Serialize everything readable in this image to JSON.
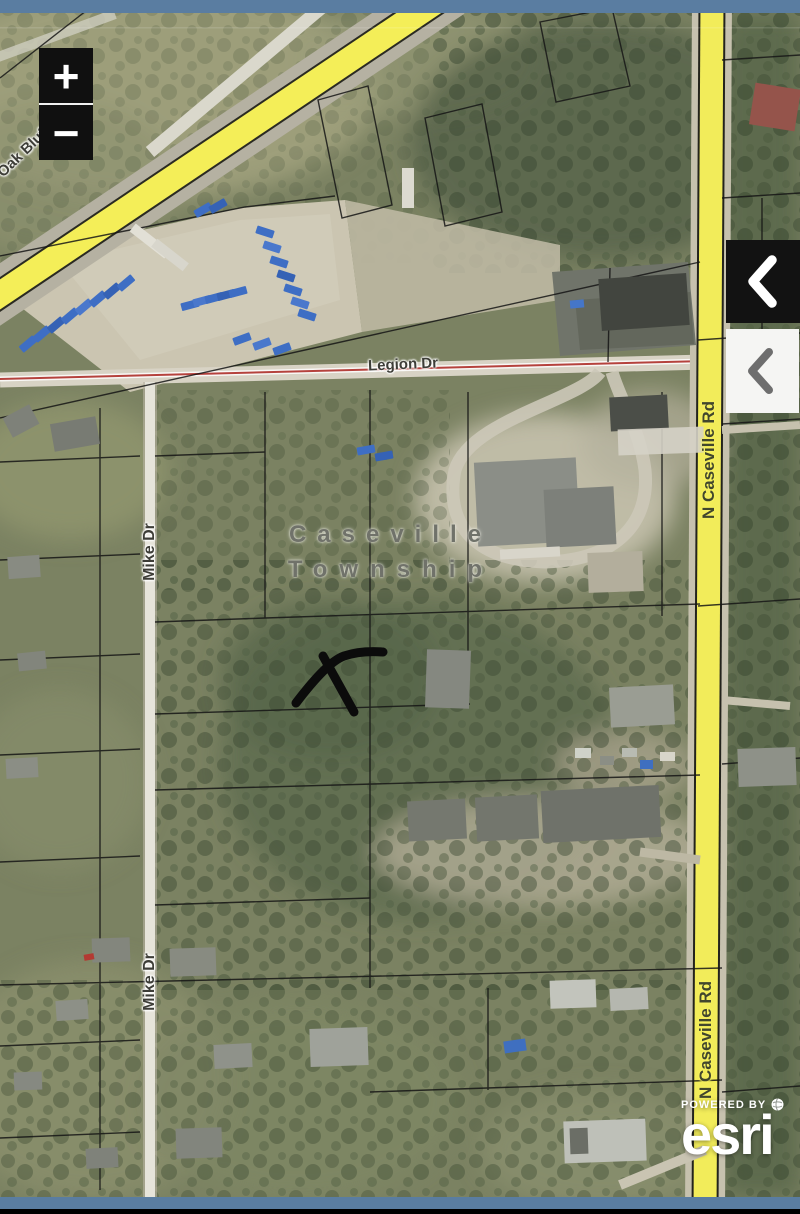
{
  "chrome": {
    "top_bar_color": "#5a7da1",
    "bottom_bar_color": "#5a7da1",
    "bottom_strip_color": "#000000"
  },
  "map": {
    "place_label": {
      "line1": "Caseville",
      "line2": "Township"
    },
    "road_labels": {
      "oak_bluff": "Oak Bluff Rd",
      "legion": "Legion Dr",
      "mike": "Mike Dr",
      "n_caseville": "N Caseville Rd"
    },
    "annotation": {
      "type": "freehand-x-mark",
      "color": "#0b0b0b"
    },
    "imagery_colors": {
      "highway_yellow": "#f4ee58",
      "legion_centerline_red": "#b5423d",
      "boat_blue": "#3e6ec4",
      "parcel_line": "#161616"
    }
  },
  "controls": {
    "zoom_in_label": "+",
    "zoom_out_label": "−",
    "dark_panel_toggle_icon": "chevron-left",
    "light_panel_toggle_icon": "chevron-left"
  },
  "attribution": {
    "powered_by": "POWERED BY",
    "brand": "esri",
    "globe_icon": "globe"
  }
}
